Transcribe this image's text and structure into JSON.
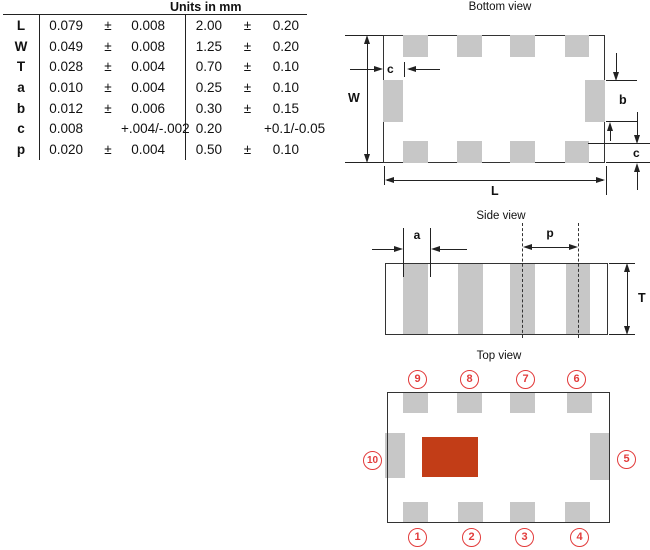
{
  "table": {
    "header": "Units in mm",
    "rows": [
      {
        "label": "L",
        "in_val": "0.079",
        "in_pm": "±",
        "in_tol": "0.008",
        "mm_val": "2.00",
        "mm_pm": "±",
        "mm_tol": "0.20"
      },
      {
        "label": "W",
        "in_val": "0.049",
        "in_pm": "±",
        "in_tol": "0.008",
        "mm_val": "1.25",
        "mm_pm": "±",
        "mm_tol": "0.20"
      },
      {
        "label": "T",
        "in_val": "0.028",
        "in_pm": "±",
        "in_tol": "0.004",
        "mm_val": "0.70",
        "mm_pm": "±",
        "mm_tol": "0.10"
      },
      {
        "label": "a",
        "in_val": "0.010",
        "in_pm": "±",
        "in_tol": "0.004",
        "mm_val": "0.25",
        "mm_pm": "±",
        "mm_tol": "0.10"
      },
      {
        "label": "b",
        "in_val": "0.012",
        "in_pm": "±",
        "in_tol": "0.006",
        "mm_val": "0.30",
        "mm_pm": "±",
        "mm_tol": "0.15"
      },
      {
        "label": "c",
        "in_val": "0.008",
        "in_pm": "",
        "in_tol": "+.004/-.002",
        "mm_val": "0.20",
        "mm_pm": "",
        "mm_tol": "+0.1/-0.05"
      },
      {
        "label": "p",
        "in_val": "0.020",
        "in_pm": "±",
        "in_tol": "0.004",
        "mm_val": "0.50",
        "mm_pm": "±",
        "mm_tol": "0.10"
      }
    ]
  },
  "views": {
    "bottom": {
      "title": "Bottom view",
      "dim_W": "W",
      "dim_L": "L",
      "dim_c_left": "c",
      "dim_b": "b",
      "dim_c_right": "c"
    },
    "side": {
      "title": "Side view",
      "dim_a": "a",
      "dim_p": "p",
      "dim_T": "T"
    },
    "top": {
      "title": "Top view",
      "pins": [
        "1",
        "2",
        "3",
        "4",
        "5",
        "6",
        "7",
        "8",
        "9",
        "10"
      ]
    }
  },
  "colors": {
    "pad_gray": "#c7c7c7",
    "marking_red": "#c23d17",
    "pin_red": "#e23b3b",
    "line": "#222222"
  }
}
